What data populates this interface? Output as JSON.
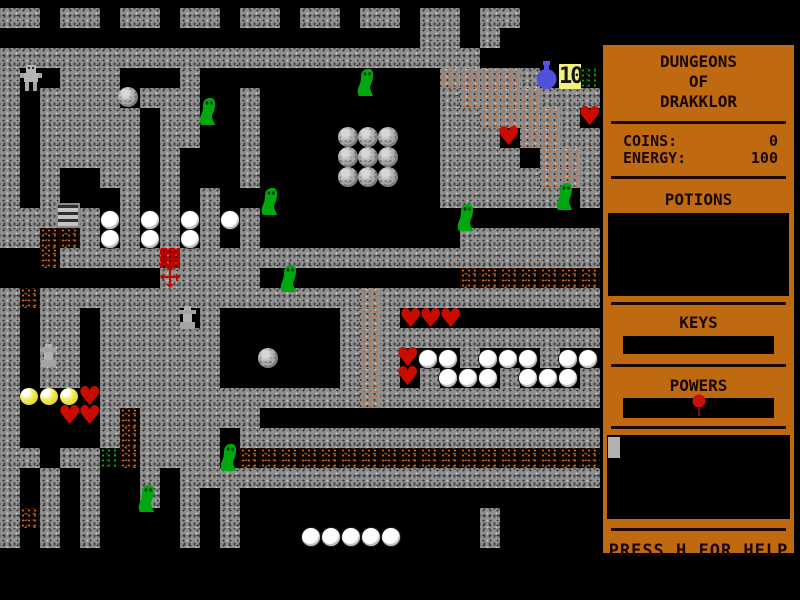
{
  "sidebar": {
    "title_lines": [
      "DUNGEONS",
      "OF",
      "DRAKKLOR"
    ],
    "stats": [
      {
        "label": "COINS:",
        "value": "0"
      },
      {
        "label": "ENERGY:",
        "value": "100"
      }
    ],
    "sections": {
      "potions": "POTIONS",
      "keys": "KEYS",
      "powers": "POWERS"
    },
    "help_text": "PRESS H FOR HELP",
    "colors": {
      "panel": "#bf6a10",
      "text": "#190700",
      "box": "#000000",
      "power_pin": "#c81010"
    }
  },
  "map": {
    "tile_size": 20,
    "origin_x": 0,
    "origin_y": 8,
    "legend": {
      "#": {
        "name": "wall",
        "color": "#909090"
      },
      ".": {
        "name": "floor",
        "color": "#000000"
      },
      "d": {
        "name": "dirt-floor",
        "color": "#c8641e"
      },
      "D": {
        "name": "dirt-wall",
        "color": "#8e8e8e"
      },
      "g": {
        "name": "moss-floor",
        "color": "#12a41a"
      },
      "R": {
        "name": "red-brick",
        "color": "#b80400"
      }
    },
    "rows": [
      "##.##.##.##.##.##.##.##.##....",
      ".....................##.#.....",
      "########################......",
      "#..###...#............DDDD#..g",
      "#.####.###..#.........#DDDD###",
      "#.#####.##..#.........##DDDD#.",
      "#.#####.##..#.........###.DD##",
      "#.#####.#...#.........####.DD#",
      "#.#..##.#...#.........#####DD#",
      "#.#...#.#.#...........######.#",
      "#####.#.#.#.#.................",
      "##dd#.#.#.#.#..........#######",
      "..d#####R#####################",
      "........#####..........ddddddd",
      "#d################D###########",
      "#.##.####.#......#D#..........",
      "#.##.######......#D###########",
      "#.##.######......#D#...#...#..",
      "#.##.######......#D#.#...#...#",
      "#....#############D###########",
      "#....#d######.................",
      "#....#d####.##################",
      "##.##gd####.dddddddddddddddddd",
      "#.#.#..#.#####################",
      "#.#.#..#.#.#..................",
      "#d#.#....#.#............#.....",
      "#.#.#....#.#............#....."
    ]
  },
  "entities": [
    {
      "t": "player",
      "x": 19,
      "y": 64
    },
    {
      "t": "slime",
      "x": 199,
      "y": 96
    },
    {
      "t": "slime",
      "x": 357,
      "y": 67
    },
    {
      "t": "slime",
      "x": 457,
      "y": 202
    },
    {
      "t": "slime",
      "x": 556,
      "y": 181
    },
    {
      "t": "slime",
      "x": 261,
      "y": 186
    },
    {
      "t": "slime",
      "x": 280,
      "y": 263
    },
    {
      "t": "slime",
      "x": 220,
      "y": 442
    },
    {
      "t": "slime",
      "x": 138,
      "y": 483
    },
    {
      "t": "boulder",
      "x": 118,
      "y": 87
    },
    {
      "t": "boulder",
      "x": 338,
      "y": 127
    },
    {
      "t": "boulder",
      "x": 358,
      "y": 127
    },
    {
      "t": "boulder",
      "x": 378,
      "y": 127
    },
    {
      "t": "boulder",
      "x": 338,
      "y": 147
    },
    {
      "t": "boulder",
      "x": 358,
      "y": 147
    },
    {
      "t": "boulder",
      "x": 378,
      "y": 147
    },
    {
      "t": "boulder",
      "x": 338,
      "y": 167
    },
    {
      "t": "boulder",
      "x": 358,
      "y": 167
    },
    {
      "t": "boulder",
      "x": 378,
      "y": 167
    },
    {
      "t": "boulder",
      "x": 258,
      "y": 348
    },
    {
      "t": "ladder",
      "x": 56,
      "y": 203
    },
    {
      "t": "statue",
      "x": 177,
      "y": 306
    },
    {
      "t": "statue",
      "x": 38,
      "y": 344
    },
    {
      "t": "cross",
      "x": 160,
      "y": 266
    },
    {
      "t": "flask",
      "x": 534,
      "y": 61
    },
    {
      "t": "badge",
      "x": 559,
      "y": 64,
      "label": "10"
    },
    {
      "t": "heart",
      "x": 578,
      "y": 108
    },
    {
      "t": "heart",
      "x": 497,
      "y": 128
    },
    {
      "t": "heart",
      "x": 399,
      "y": 310
    },
    {
      "t": "heart",
      "x": 419,
      "y": 310
    },
    {
      "t": "heart",
      "x": 439,
      "y": 310
    },
    {
      "t": "heart",
      "x": 396,
      "y": 349
    },
    {
      "t": "heart",
      "x": 396,
      "y": 368
    },
    {
      "t": "heart",
      "x": 78,
      "y": 388
    },
    {
      "t": "heart",
      "x": 58,
      "y": 407
    },
    {
      "t": "heart",
      "x": 78,
      "y": 407
    },
    {
      "t": "coin",
      "x": 20,
      "y": 388
    },
    {
      "t": "coin",
      "x": 40,
      "y": 388
    },
    {
      "t": "coin",
      "x": 60,
      "y": 388
    },
    {
      "t": "egg",
      "x": 101,
      "y": 211
    },
    {
      "t": "egg",
      "x": 101,
      "y": 230
    },
    {
      "t": "egg",
      "x": 141,
      "y": 211
    },
    {
      "t": "egg",
      "x": 141,
      "y": 230
    },
    {
      "t": "egg",
      "x": 181,
      "y": 211
    },
    {
      "t": "egg",
      "x": 181,
      "y": 230
    },
    {
      "t": "egg",
      "x": 221,
      "y": 211
    },
    {
      "t": "egg",
      "x": 419,
      "y": 350
    },
    {
      "t": "egg",
      "x": 439,
      "y": 350
    },
    {
      "t": "egg",
      "x": 479,
      "y": 350
    },
    {
      "t": "egg",
      "x": 499,
      "y": 350
    },
    {
      "t": "egg",
      "x": 519,
      "y": 350
    },
    {
      "t": "egg",
      "x": 559,
      "y": 350
    },
    {
      "t": "egg",
      "x": 579,
      "y": 350
    },
    {
      "t": "egg",
      "x": 439,
      "y": 369
    },
    {
      "t": "egg",
      "x": 459,
      "y": 369
    },
    {
      "t": "egg",
      "x": 479,
      "y": 369
    },
    {
      "t": "egg",
      "x": 519,
      "y": 369
    },
    {
      "t": "egg",
      "x": 539,
      "y": 369
    },
    {
      "t": "egg",
      "x": 559,
      "y": 369
    },
    {
      "t": "egg",
      "x": 302,
      "y": 528
    },
    {
      "t": "egg",
      "x": 322,
      "y": 528
    },
    {
      "t": "egg",
      "x": 342,
      "y": 528
    },
    {
      "t": "egg",
      "x": 362,
      "y": 528
    },
    {
      "t": "egg",
      "x": 382,
      "y": 528
    }
  ]
}
